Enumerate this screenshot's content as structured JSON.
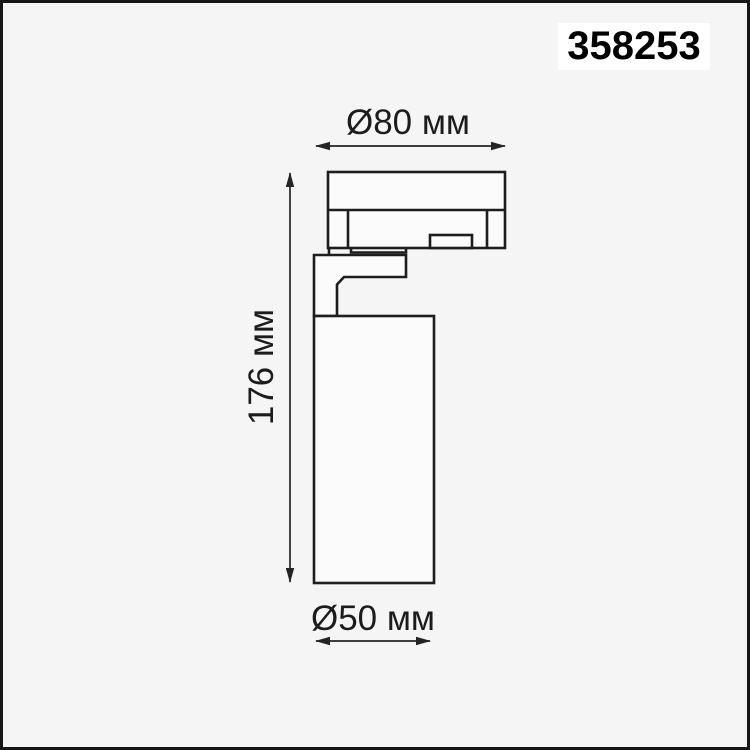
{
  "product": {
    "article": "358253"
  },
  "drawing": {
    "description": "technical dimension drawing of track spotlight, side view",
    "dimensions": {
      "top": {
        "label": "Ø80 мм",
        "value_mm": 80
      },
      "height": {
        "label": "176 мм",
        "value_mm": 176
      },
      "bottom": {
        "label": "Ø50 мм",
        "value_mm": 50
      }
    }
  },
  "colors": {
    "background": "#f5f5f6",
    "frame_border": "#161616",
    "outline": "#1d1d1d",
    "dimension": "#242424",
    "label_background": "#ffffff",
    "title_text": "#000000"
  }
}
